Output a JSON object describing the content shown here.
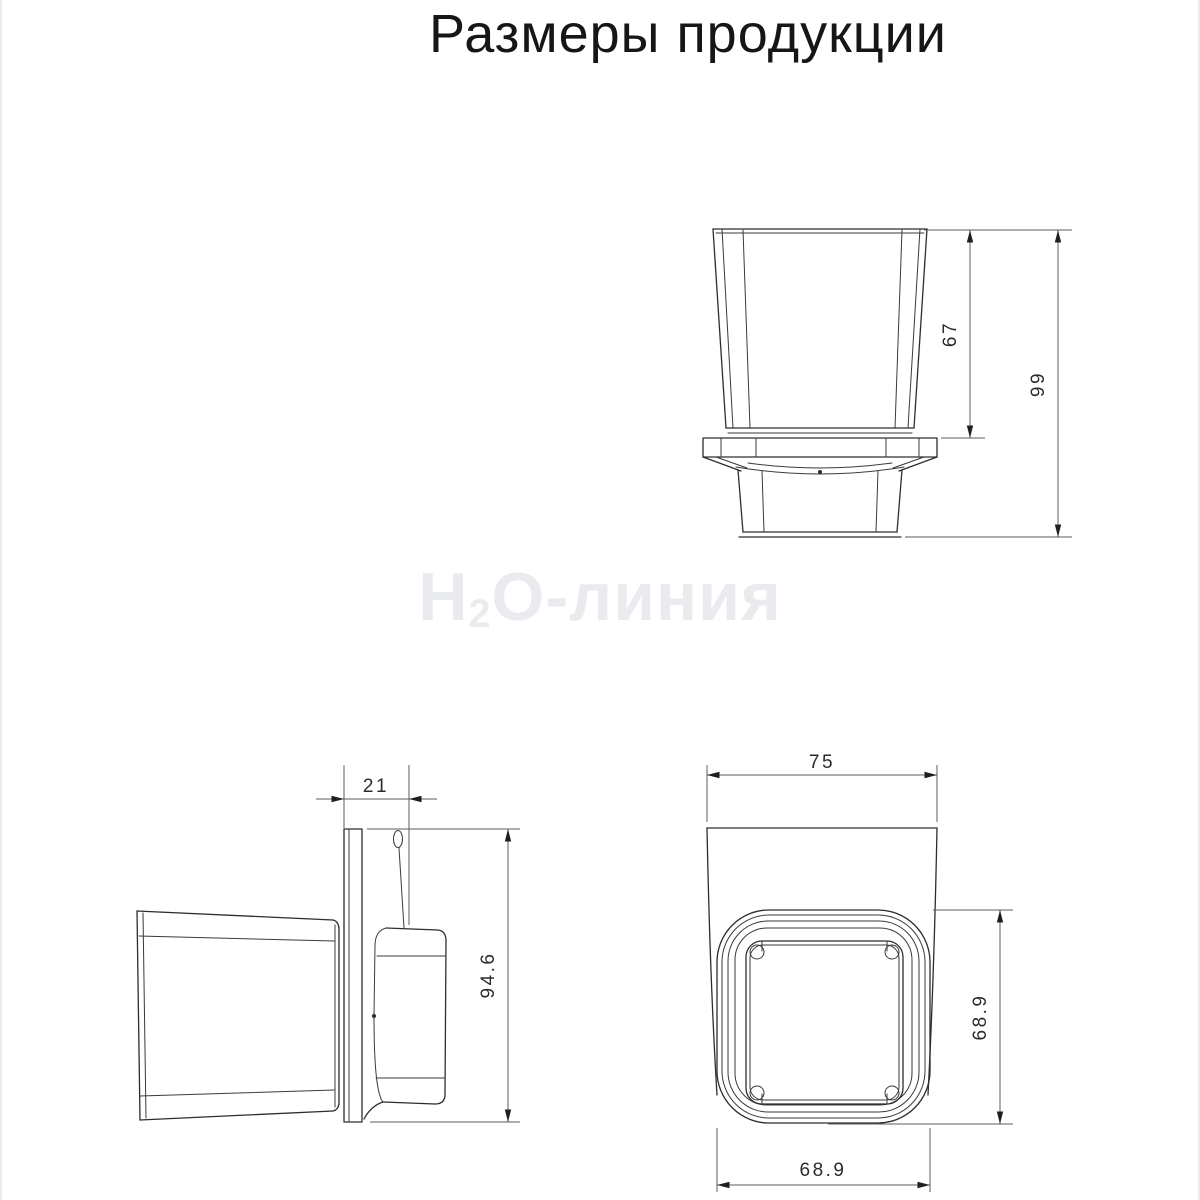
{
  "title": "Размеры продукции",
  "watermark": {
    "prefix": "H",
    "subscript": "2",
    "suffix": "O-линия"
  },
  "views": {
    "front": {
      "description": "front view of glass tumbler in wall holder",
      "dim_cup_height": "67",
      "dim_total_height": "99"
    },
    "side": {
      "description": "side view with wall plate and mounting bracket",
      "dim_bracket_depth": "21",
      "dim_mount_height": "94.6"
    },
    "top": {
      "description": "top view of holder rim",
      "dim_outer_width": "75",
      "dim_inner_depth": "68.9",
      "dim_inner_width": "68.9"
    }
  },
  "colors": {
    "line": "#2d2d2d",
    "dimension_line": "#5d5d5d",
    "watermark": "#e9ebee",
    "background": "#ffffff"
  }
}
